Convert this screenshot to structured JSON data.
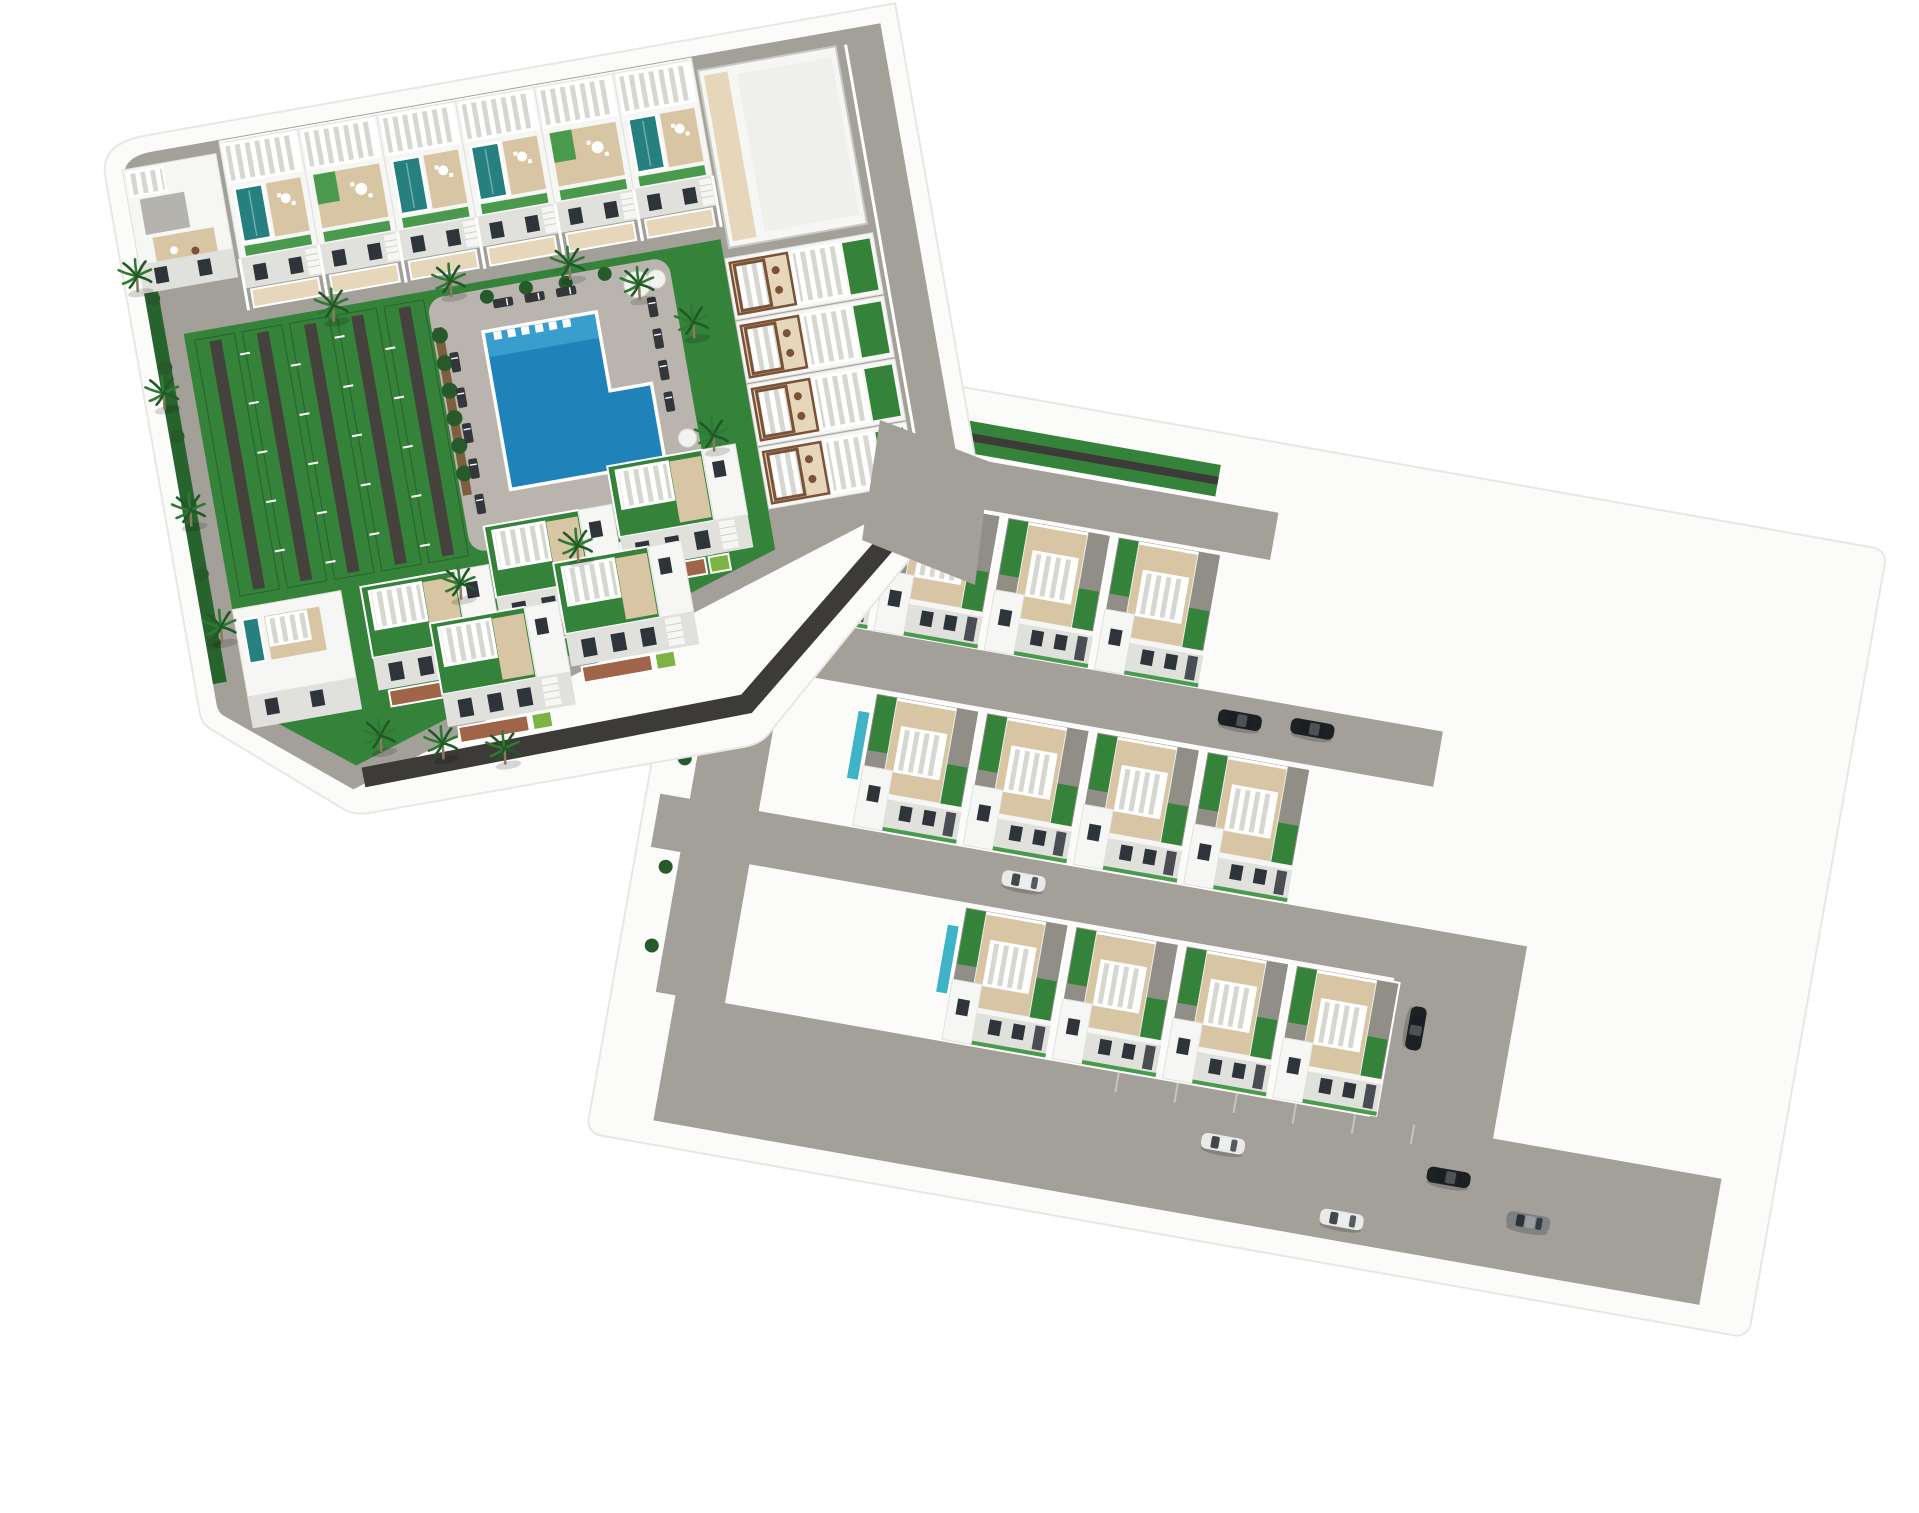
{
  "image": {
    "kind": "3D aerial architectural render",
    "description": "Aerial 3D rendering of a white Mediterranean residential development: a main block of terraced townhouses with rooftop plunge pools and white pergolas surrounding a communal courtyard with an L-shaped swimming pool, sun loungers, lawns, palm trees and grass parking strips; a lower wing with three stepped rows of semi-detached villas with roof-deck terraces, pergolas and private lap pools; gray access roads and a parking esplanade with parked cars, all sitting on a white model base."
  },
  "colors": {
    "background": "#ffffff",
    "road": "#a3a099",
    "road_shade": "#918e87",
    "dark_path": "#3d3b37",
    "lawn": "#35823a",
    "lawn_dark": "#27632c",
    "lawn_light": "#4a9a4e",
    "hedge": "#275a2b",
    "stone_wall": "#7d5f3e",
    "building": "#f6f6f4",
    "building_shade": "#e0e0dc",
    "building_dark": "#c9c9c4",
    "gray_roof": "#b5b3ae",
    "window": "#2f343a",
    "deck": "#d8c5a3",
    "deck_light": "#e6d7ba",
    "patio_brick": "#a06449",
    "lime_patch": "#7cb342",
    "pergola_slat_shadow": "#d7d7d2",
    "wood": "#7a5238",
    "pool_main": "#1f83ba",
    "pool_deep": "#14659c",
    "pool_light": "#4fb3dc",
    "roof_pool": "#25807f",
    "villa_pool": "#3fb4c6",
    "palm_frond": "#2f7a33",
    "palm_frond_dark": "#1f5a26",
    "palm_trunk": "#8b7a5c",
    "lounger": "#33363a",
    "car_black": "#1e2124",
    "car_white": "#e8e9e9",
    "car_gray": "#7e8184",
    "plinth": "#fbfbfa",
    "plinth_edge": "#e9e7e3"
  },
  "inventory": {
    "townhouses_north_row": 6,
    "rooftop_plunge_pools": 5,
    "apartment_units_east": 4,
    "large_corner_buildings": 2,
    "detached_houses_south": 5,
    "villa_rows": 3,
    "villas_per_row": 4,
    "villa_lap_pools": 3,
    "communal_pools": 1,
    "pergola_cabanas": 3,
    "sun_loungers": 12,
    "round_daybeds": 2,
    "grass_parking_strips": 5,
    "palm_trees": 16,
    "cars": 8
  }
}
